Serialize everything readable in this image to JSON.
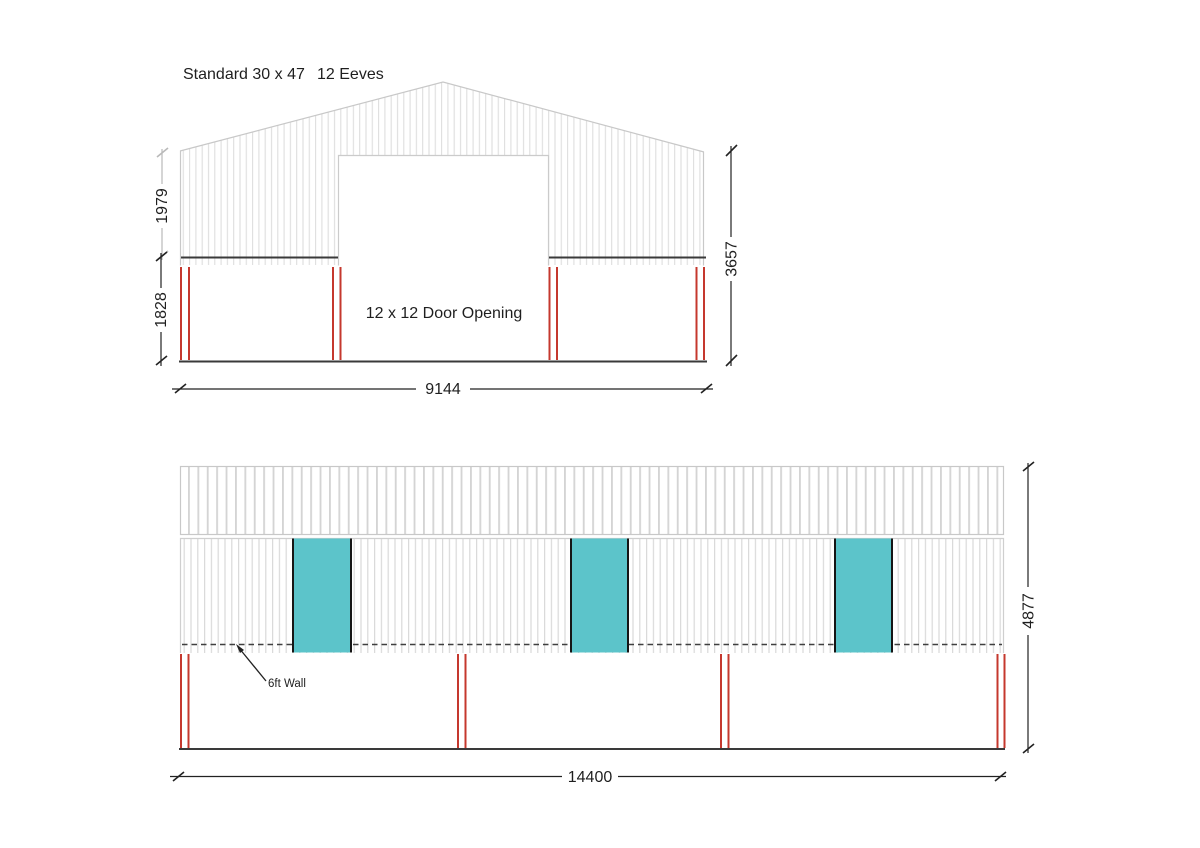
{
  "title": {
    "model": "Standard 30 x 47",
    "eaves": "12 Eeves"
  },
  "end_elevation": {
    "door_label": "12 x 12 Door Opening",
    "dims": {
      "width": "9144",
      "total_height": "3657",
      "upper_panel_height": "1979",
      "lower_wall_height": "1828"
    }
  },
  "side_elevation": {
    "wall_label": "6ft Wall",
    "dims": {
      "width": "14400",
      "total_height": "4877"
    }
  },
  "colors": {
    "door_teal": "#5cc4ca",
    "frame_red": "#c5382e",
    "dim_gray": "#b9b9b9",
    "line_dark": "#3a3a3a",
    "panel_rib_gray": "#dcdcdc",
    "outline_gray": "#c8c8c8",
    "text_black": "#1f1f1f"
  }
}
